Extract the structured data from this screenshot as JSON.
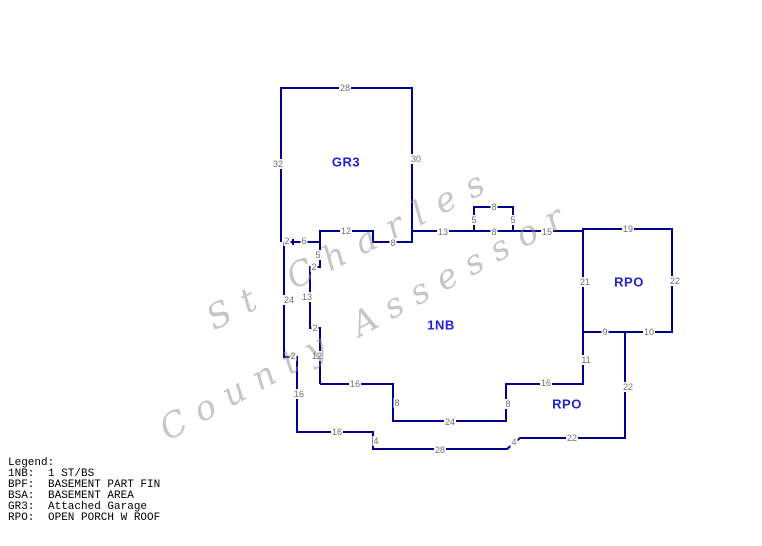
{
  "colors": {
    "line": "#00008B",
    "region_label": "#2222CC",
    "dimension_label": "#6F6F6F",
    "watermark": "#8E8E8E",
    "background": "#FFFFFF"
  },
  "watermark": {
    "lines": [
      {
        "text": "St Charles",
        "x": 200,
        "y": 303,
        "angle": -27,
        "spacing": 14
      },
      {
        "text": "County Assessor",
        "x": 153,
        "y": 414,
        "angle": -28.5,
        "spacing": 12
      }
    ]
  },
  "sketch": {
    "polylines": [
      {
        "name": "garage-outline",
        "points": [
          [
            281,
            242
          ],
          [
            281,
            88
          ],
          [
            412,
            88
          ],
          [
            412,
            231
          ]
        ]
      },
      {
        "name": "main-top-edge",
        "points": [
          [
            284,
            242
          ],
          [
            320,
            242
          ],
          [
            320,
            231
          ],
          [
            373,
            231
          ],
          [
            373,
            242
          ],
          [
            412,
            242
          ],
          [
            412,
            231
          ],
          [
            583,
            231
          ],
          [
            583,
            229
          ]
        ]
      },
      {
        "name": "top-bump",
        "points": [
          [
            474,
            231
          ],
          [
            474,
            207
          ],
          [
            513,
            207
          ],
          [
            513,
            231
          ]
        ]
      },
      {
        "name": "rpo-top-rect",
        "points": [
          [
            583,
            332
          ],
          [
            583,
            229
          ],
          [
            672,
            229
          ],
          [
            672,
            332
          ],
          [
            583,
            332
          ]
        ]
      },
      {
        "name": "outer-left-bottom",
        "points": [
          [
            625,
            332
          ],
          [
            625,
            438
          ],
          [
            520,
            438
          ],
          [
            507,
            449
          ],
          [
            373,
            449
          ],
          [
            373,
            432
          ],
          [
            297,
            432
          ],
          [
            297,
            357
          ],
          [
            284,
            357
          ],
          [
            284,
            242
          ]
        ]
      },
      {
        "name": "main-bottom-edge",
        "points": [
          [
            583,
            332
          ],
          [
            583,
            384
          ],
          [
            506,
            384
          ],
          [
            506,
            421
          ],
          [
            393,
            421
          ],
          [
            393,
            384
          ],
          [
            320,
            384
          ]
        ]
      },
      {
        "name": "interior-left-line",
        "points": [
          [
            320,
            242
          ],
          [
            320,
            267
          ],
          [
            310,
            267
          ],
          [
            310,
            328
          ],
          [
            320,
            328
          ],
          [
            320,
            384
          ]
        ]
      },
      {
        "name": "tick-mark",
        "points": [
          [
            293,
            239
          ],
          [
            293,
            245
          ]
        ]
      }
    ],
    "dimension_labels": [
      {
        "t": "28",
        "x": 345,
        "y": 88
      },
      {
        "t": "32",
        "x": 278,
        "y": 164
      },
      {
        "t": "30",
        "x": 416,
        "y": 159
      },
      {
        "t": "2",
        "x": 287,
        "y": 241
      },
      {
        "t": "6",
        "x": 304,
        "y": 241
      },
      {
        "t": "12",
        "x": 346,
        "y": 231
      },
      {
        "t": "8",
        "x": 393,
        "y": 243
      },
      {
        "t": "13",
        "x": 443,
        "y": 232
      },
      {
        "t": "5",
        "x": 474,
        "y": 220
      },
      {
        "t": "8",
        "x": 494,
        "y": 207
      },
      {
        "t": "5",
        "x": 513,
        "y": 220
      },
      {
        "t": "8",
        "x": 494,
        "y": 232
      },
      {
        "t": "15",
        "x": 547,
        "y": 232
      },
      {
        "t": "19",
        "x": 628,
        "y": 229
      },
      {
        "t": "21",
        "x": 585,
        "y": 282
      },
      {
        "t": "22",
        "x": 675,
        "y": 281
      },
      {
        "t": "9",
        "x": 605,
        "y": 332
      },
      {
        "t": "10",
        "x": 649,
        "y": 332
      },
      {
        "t": "11",
        "x": 586,
        "y": 360
      },
      {
        "t": "22",
        "x": 628,
        "y": 387
      },
      {
        "t": "16",
        "x": 546,
        "y": 383
      },
      {
        "t": "8",
        "x": 508,
        "y": 404
      },
      {
        "t": "24",
        "x": 450,
        "y": 422
      },
      {
        "t": "8",
        "x": 397,
        "y": 403
      },
      {
        "t": "16",
        "x": 355,
        "y": 384
      },
      {
        "t": "5",
        "x": 318,
        "y": 255
      },
      {
        "t": "2",
        "x": 314,
        "y": 267
      },
      {
        "t": "13",
        "x": 307,
        "y": 297
      },
      {
        "t": "2",
        "x": 315,
        "y": 328
      },
      {
        "t": "12",
        "x": 317,
        "y": 356
      },
      {
        "t": "24",
        "x": 289,
        "y": 300
      },
      {
        "t": "2",
        "x": 293,
        "y": 356
      },
      {
        "t": "16",
        "x": 299,
        "y": 394
      },
      {
        "t": "16",
        "x": 337,
        "y": 432
      },
      {
        "t": "4",
        "x": 376,
        "y": 441
      },
      {
        "t": "28",
        "x": 440,
        "y": 450
      },
      {
        "t": "4",
        "x": 514,
        "y": 442
      },
      {
        "t": "22",
        "x": 572,
        "y": 438
      }
    ],
    "region_labels": [
      {
        "t": "GR3",
        "x": 346,
        "y": 162
      },
      {
        "t": "1NB",
        "x": 441,
        "y": 325
      },
      {
        "t": "RPO",
        "x": 629,
        "y": 282
      },
      {
        "t": "RPO",
        "x": 567,
        "y": 404
      }
    ]
  },
  "legend": {
    "title": "Legend:",
    "entries": [
      {
        "code": "1NB:",
        "desc": "1 ST/BS"
      },
      {
        "code": "BPF:",
        "desc": "BASEMENT PART FIN"
      },
      {
        "code": "BSA:",
        "desc": "BASEMENT AREA"
      },
      {
        "code": "GR3:",
        "desc": "Attached Garage"
      },
      {
        "code": "RPO:",
        "desc": "OPEN PORCH W ROOF"
      }
    ]
  }
}
